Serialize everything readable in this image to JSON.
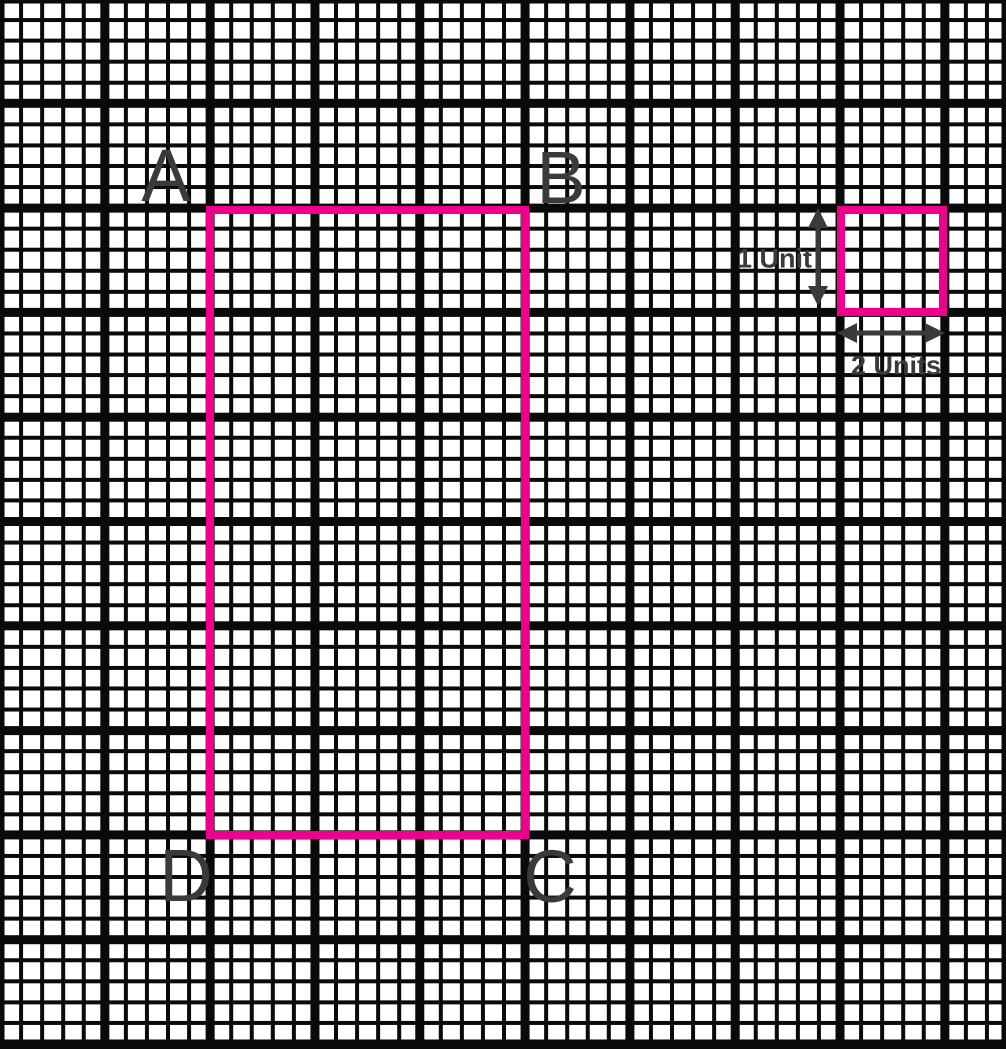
{
  "colors": {
    "paper": "#FFFFFF",
    "line": "#0A0A0A",
    "ink": "#3A3A3A",
    "pink": "#EC008C"
  },
  "corner_labels": {
    "top_left": "A",
    "top_right": "B",
    "bottom_right": "C",
    "bottom_left": "D"
  },
  "unit_key": {
    "vertical_label": "1 Unit",
    "horizontal_label": "2 Units"
  },
  "figure": {
    "type": "rectangle-on-grid-paper",
    "description": "Rectangle ABCD outlined in pink on graph paper; a small pink key square at top right is marked 1 Unit tall and 2 Units wide with double-headed arrows.",
    "rectangle_bold_blocks_wide": 3,
    "rectangle_bold_blocks_tall": 6,
    "key_square_bold_blocks": 1,
    "small_cells_per_bold_block": 5
  }
}
